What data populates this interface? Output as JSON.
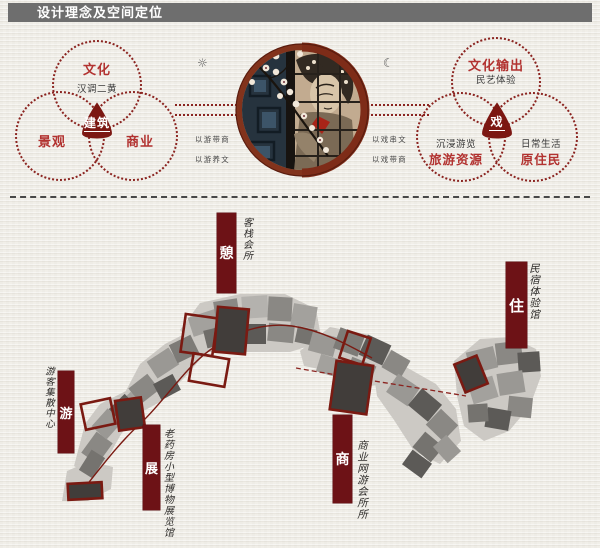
{
  "title": "设计理念及空间定位",
  "venn_left": {
    "top_label": "文化",
    "top_sub": "汉调二黄",
    "bottom_left_label": "景观",
    "bottom_right_label": "商业",
    "center_label": "建筑",
    "note1": "以游带商",
    "note2": "以游养文"
  },
  "venn_right": {
    "top_label": "文化输出",
    "top_sub": "民艺体验",
    "bottom_left_sub": "沉浸游览",
    "bottom_left_label": "旅游资源",
    "bottom_right_sub": "日常生活",
    "bottom_right_label": "原住民",
    "center_label": "戏",
    "note1": "以戏串文",
    "note2": "以戏带商"
  },
  "icons": {
    "sun": "☼",
    "moon": "☾"
  },
  "map": {
    "zones": [
      {
        "banner": "憩",
        "label": "客栈会所"
      },
      {
        "banner": "住",
        "label": "民宿体验馆"
      },
      {
        "banner": "游",
        "label": "游客集散中心"
      },
      {
        "banner": "展",
        "label": "老药房小型博物展览馆"
      },
      {
        "banner": "商",
        "label": "商业网游会所所"
      }
    ]
  },
  "colors": {
    "accent": "#7a1a12",
    "banner": "#6d1216",
    "venn_dot": "#8b2420",
    "red_label": "#b23230",
    "titlebar": "#6e6e6e"
  }
}
